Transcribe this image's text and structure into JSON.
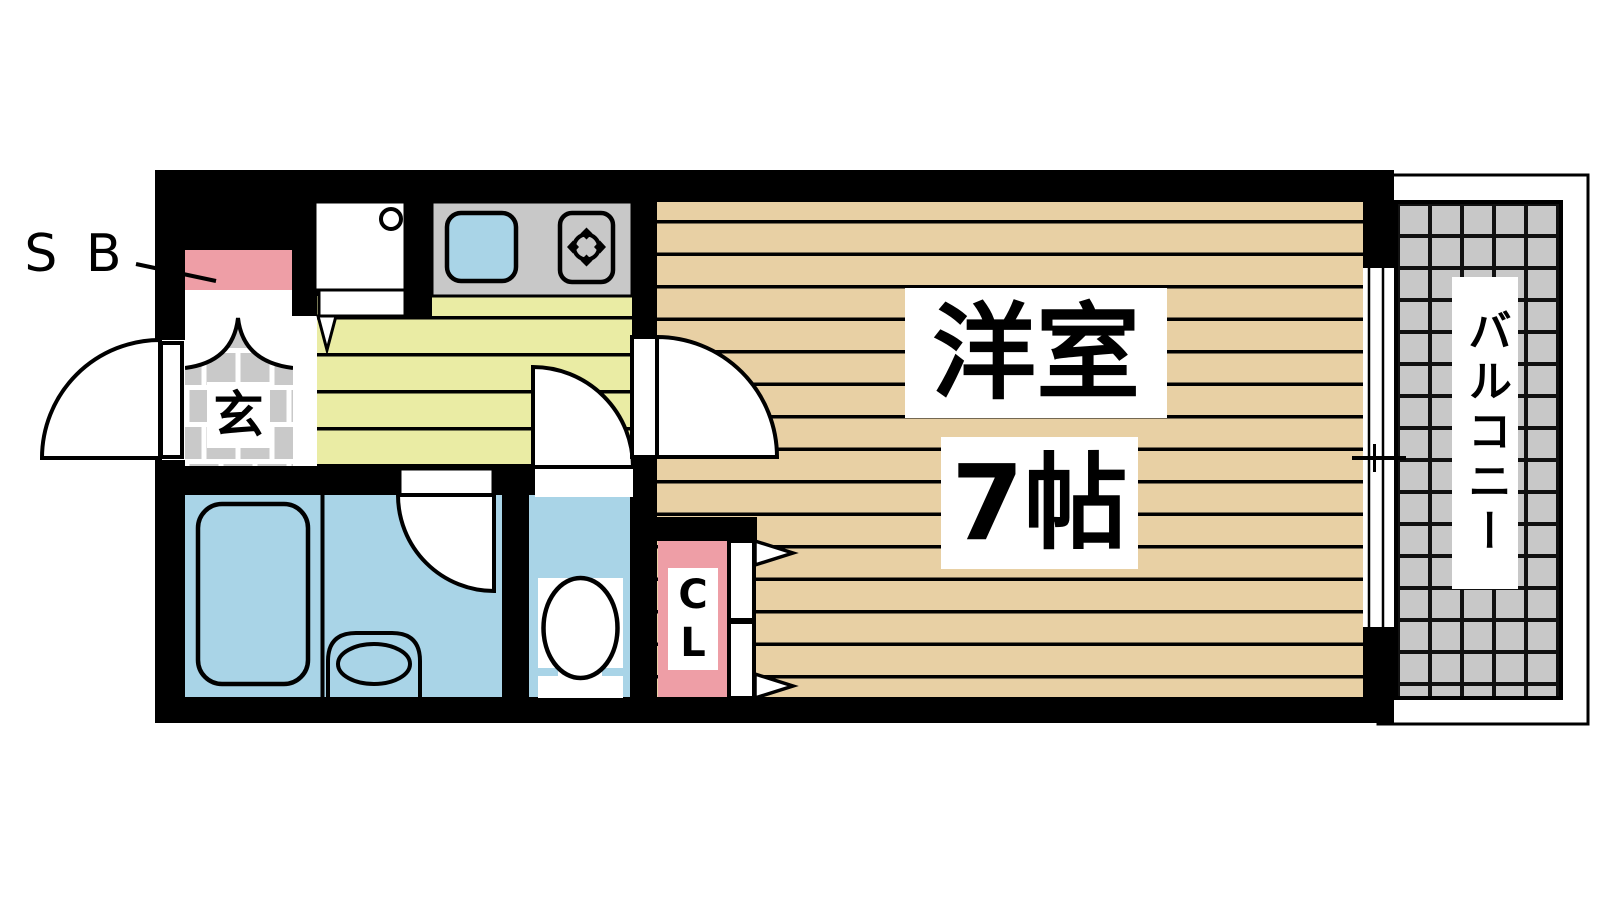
{
  "floor_plan": {
    "labels": {
      "shoe_box": "S B",
      "entrance": "玄",
      "closet_line1": "C",
      "closet_line2": "L",
      "main_room_name": "洋室",
      "main_room_size": "7帖",
      "balcony": "バルコニー"
    },
    "colors": {
      "wall": "#000000",
      "wood_floor": "#e8d0a4",
      "kitchen_floor": "#eaeca4",
      "water_blue": "#a9d4e7",
      "accent_pink": "#ee9ea6",
      "tile_gray": "#c8c8c8",
      "background": "#ffffff"
    }
  }
}
